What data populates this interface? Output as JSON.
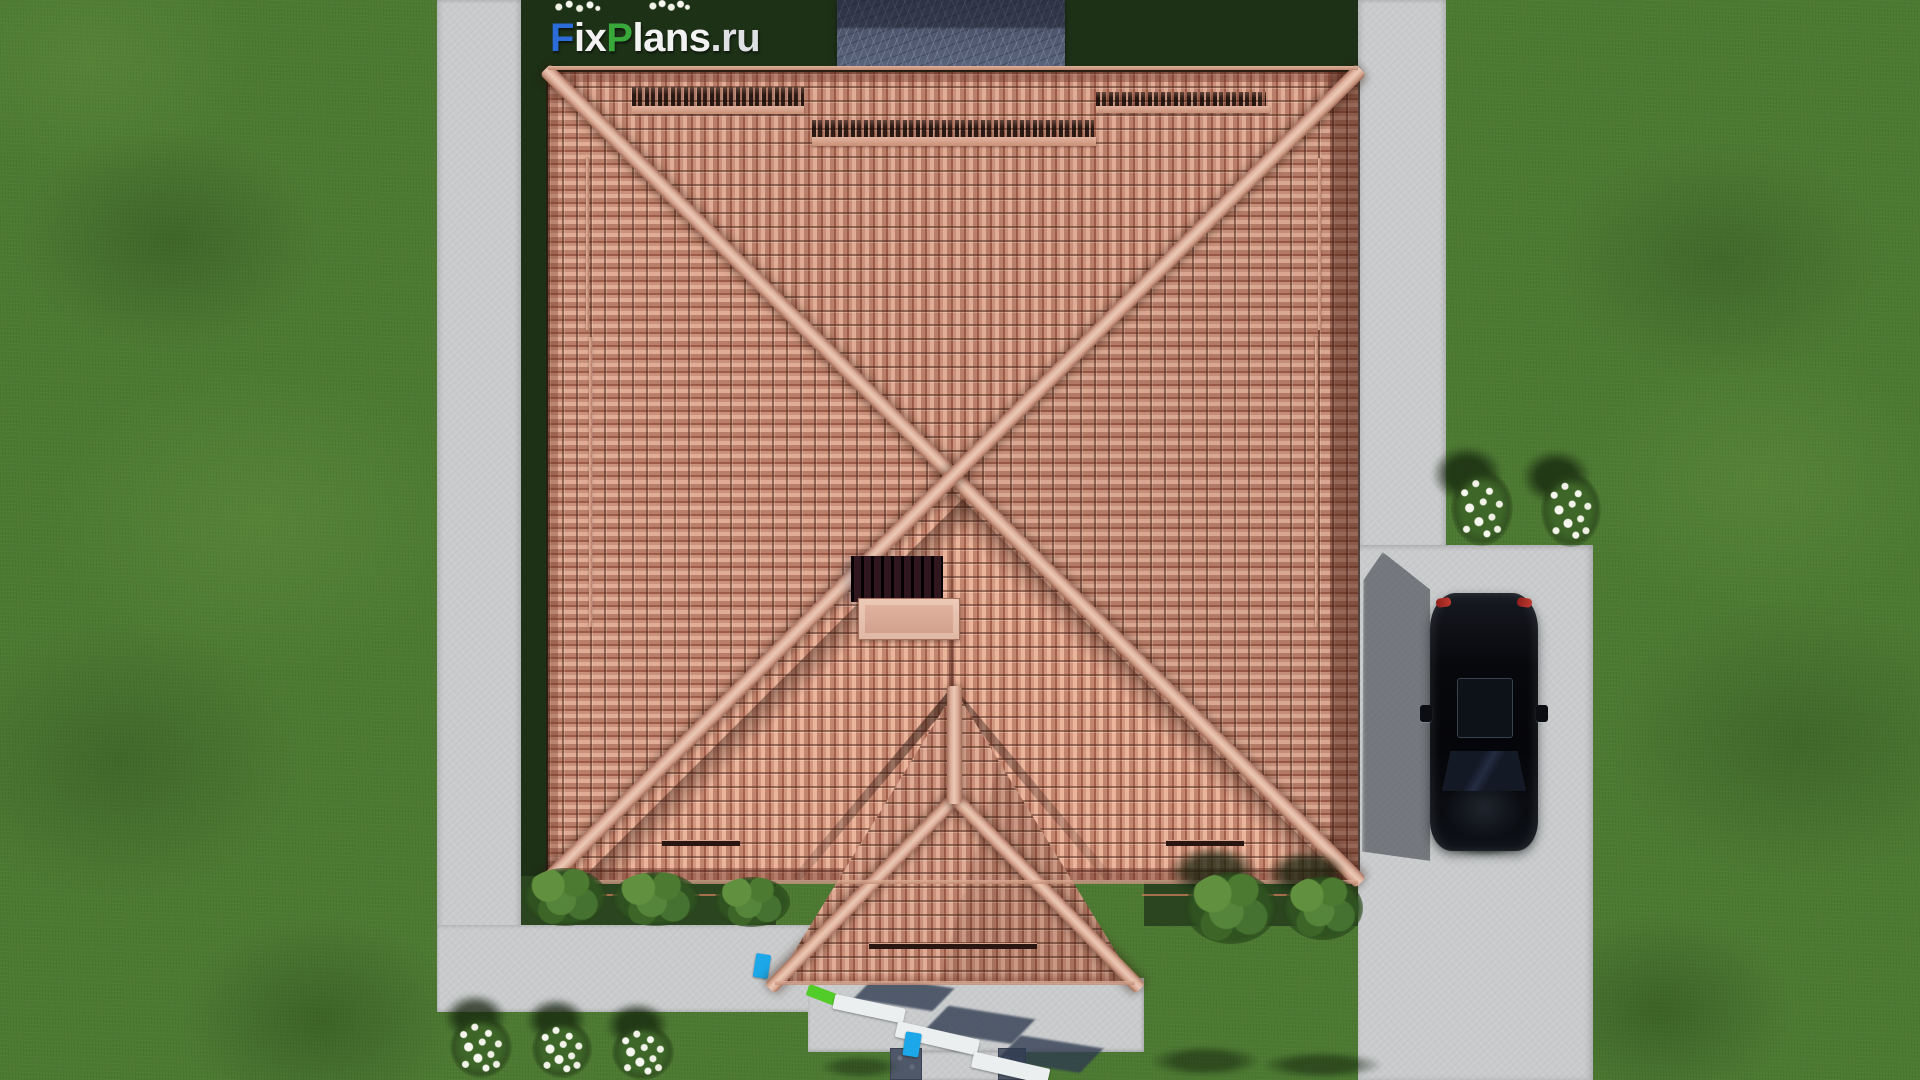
{
  "watermark": {
    "text": "FixPlans.ru",
    "segments": [
      {
        "text": "F",
        "css": "color:#2b6cd9"
      },
      {
        "text": "ix",
        "css": "color:#f2f2f2"
      },
      {
        "text": "P",
        "css": "color:#39a83b"
      },
      {
        "text": "lans",
        "css": "color:#f2f2f2"
      },
      {
        "text": ".ru",
        "css": "color:#dfe0e4"
      }
    ]
  },
  "scene": {
    "description": "Top-down aerial 3D architectural render of a house plot",
    "objects": {
      "roof": "terracotta tiled hip roof with diagonal X ridges",
      "porch_roof": "gabled entrance porch roof at bottom center",
      "chimney": "chimney cap with dark cast shadow on roof",
      "roof_vents": "three dark ridge ventilation strips near top edge",
      "snow_guards": "thin snow-guard bars on roof slopes",
      "rear_terrace": "gray stone terrace at top center",
      "left_path": "concrete path along left side",
      "right_path": "concrete path along right side",
      "driveway": "wide concrete driveway at right with parked car",
      "car": "black car seen from above, sunroof and red taillights",
      "entrance_patio": "concrete entrance patio with white steps and planters",
      "front_walkway": "walkway to bottom edge with two dark stone pavers",
      "vegetation": "lawn, green shrubs and white flower bushes with shadows"
    },
    "palette": {
      "grass": "#4d7a33",
      "grass_shadow": "#1d3117",
      "concrete": "#c9cbcc",
      "roof_tile": "#c9917c",
      "roof_ridge": "#ecc9b5",
      "terrace_stone": "#515b70",
      "car_body": "#0a0c10",
      "logo_blue": "#2b6cd9",
      "logo_green": "#39a83b",
      "accent_blue_item": "#1ba7e8",
      "accent_green_item": "#52cc28"
    }
  }
}
